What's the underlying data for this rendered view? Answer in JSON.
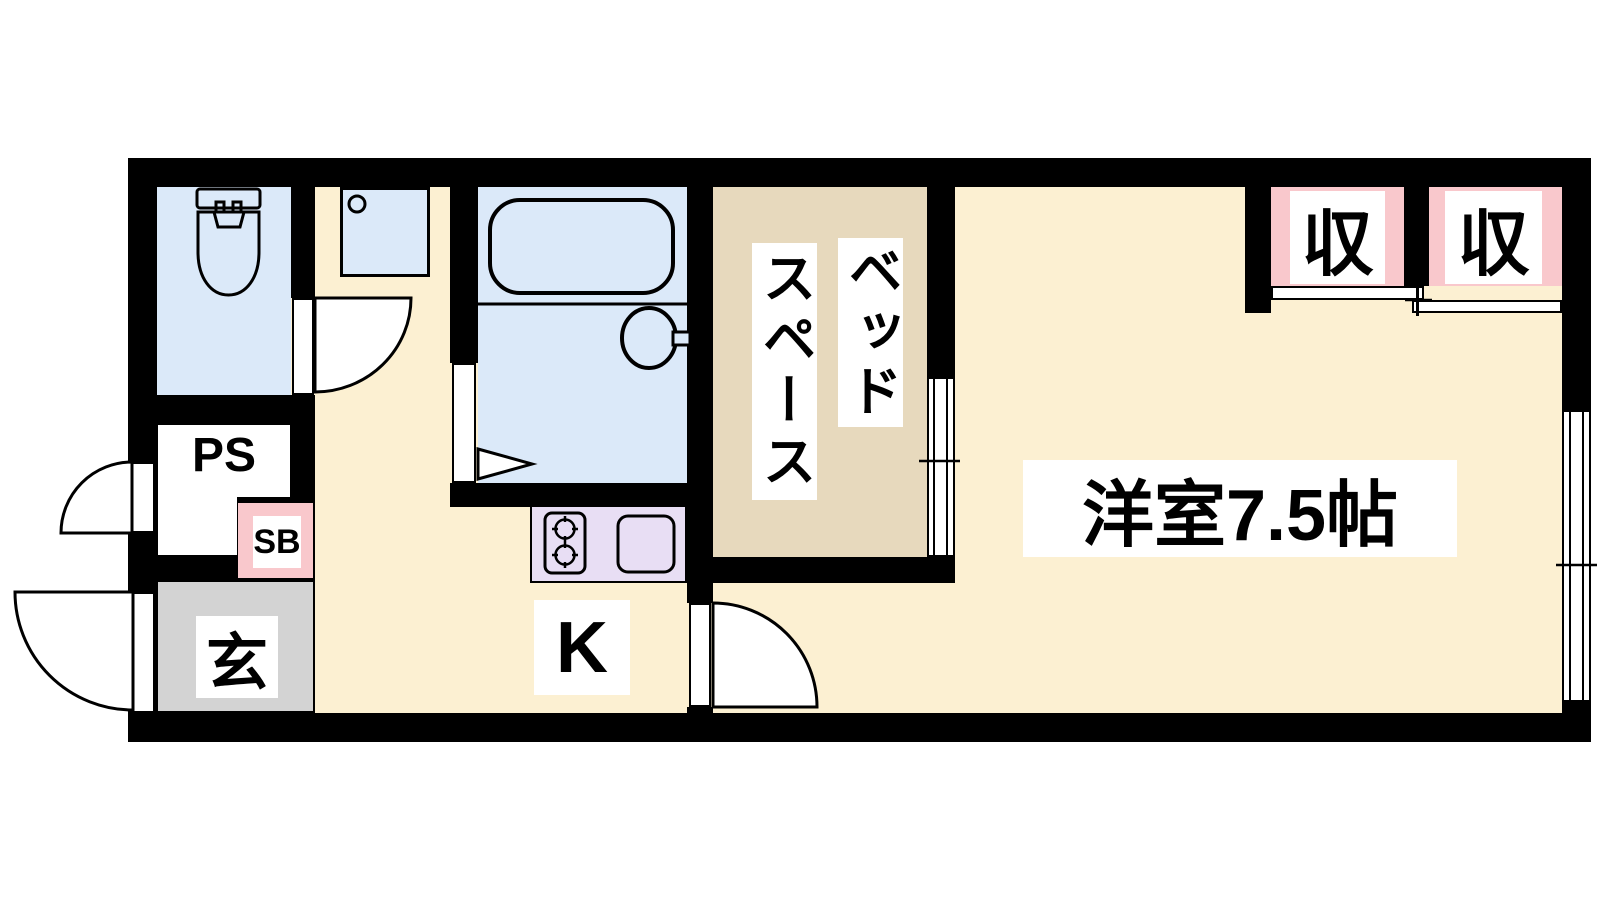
{
  "meta": {
    "type": "apartment-floor-plan"
  },
  "rooms": {
    "western_room": "洋室7.5帖",
    "bed_space_col1": "ベッド",
    "bed_space_col2": "スペース",
    "kitchen": "K",
    "entrance": "玄",
    "pipe_space": "PS",
    "shoe_box": "SB",
    "closet_1": "収",
    "closet_2": "収"
  },
  "colors": {
    "wall": "#000000",
    "floor": "#fcf0d2",
    "wet_area_blue": "#dbe9f9",
    "bed_space_tan": "#e7d9bd",
    "closet_pink": "#f9c8cc",
    "kitchen_counter_lavender": "#e8def4",
    "entrance_gray": "#d3d3d3",
    "label_bg": "#ffffff"
  }
}
